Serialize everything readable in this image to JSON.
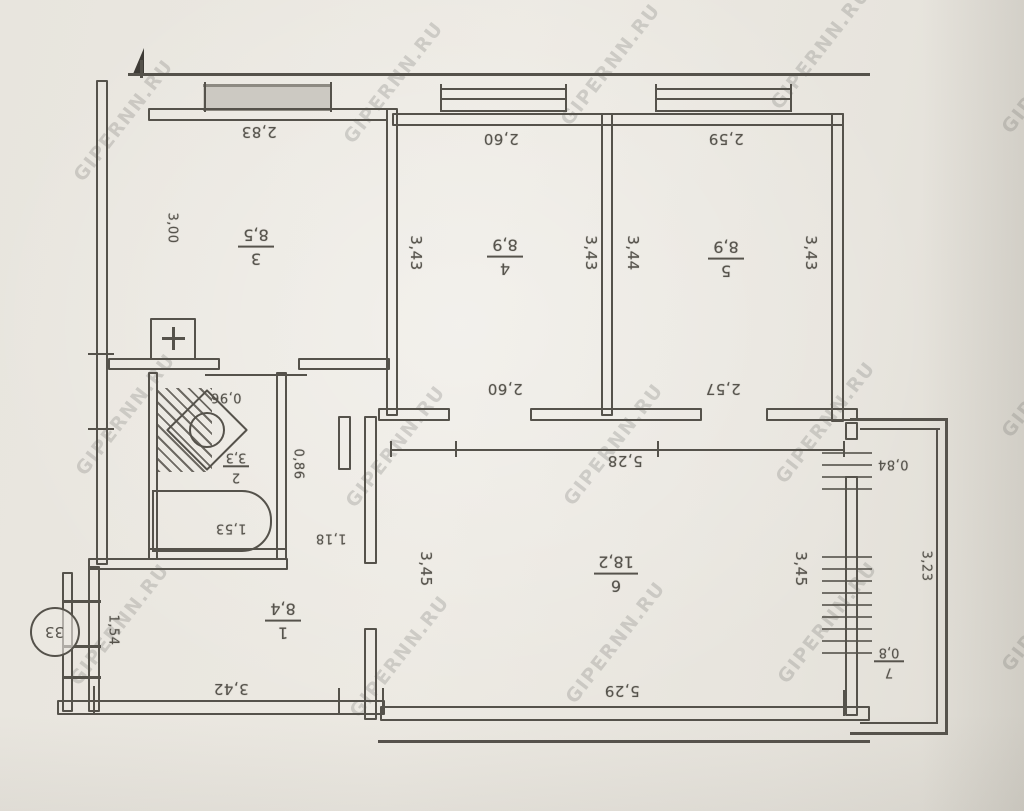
{
  "document": {
    "type": "apartment floor plan (scanned, shown upside down)",
    "apartment_number": "33",
    "watermark": {
      "text": "GIPERNN.RU",
      "positions": [
        [
          78,
          168
        ],
        [
          348,
          130
        ],
        [
          565,
          112
        ],
        [
          775,
          96
        ],
        [
          1006,
          120
        ],
        [
          80,
          462
        ],
        [
          350,
          494
        ],
        [
          568,
          492
        ],
        [
          780,
          470
        ],
        [
          1006,
          424
        ],
        [
          74,
          672
        ],
        [
          354,
          704
        ],
        [
          570,
          690
        ],
        [
          782,
          670
        ],
        [
          1006,
          658
        ]
      ]
    }
  },
  "rooms": [
    {
      "number": "1",
      "area": "8,4"
    },
    {
      "number": "2",
      "area": "3,3"
    },
    {
      "number": "3",
      "area": "8,5"
    },
    {
      "number": "4",
      "area": "8,9"
    },
    {
      "number": "5",
      "area": "8,9"
    },
    {
      "number": "6",
      "area": "18,2"
    },
    {
      "number": "7",
      "area": "0,8"
    }
  ],
  "dims": {
    "room3_top": "2,83",
    "room3_left": "3,00",
    "room4_top": "2,60",
    "room4_bottom": "2,60",
    "room4_left": "3,43",
    "room4_right": "3,43",
    "room5_top": "2,59",
    "room5_bottom": "2,57",
    "room5_left": "3,44",
    "room5_right": "3,43",
    "room6_top": "5,28",
    "room6_bottom": "5,29",
    "room6_left": "3,45",
    "room6_right": "3,45",
    "room1_bottom": "3,42",
    "room1_left": "1,54",
    "room2_niche": "0,96",
    "bathtub_length": "1,53",
    "room2_side": "0,86",
    "corridor_width": "1,18",
    "balcony_top": "0,84",
    "balcony_side": "3,23"
  },
  "icons": {
    "vent_plus": "+"
  }
}
